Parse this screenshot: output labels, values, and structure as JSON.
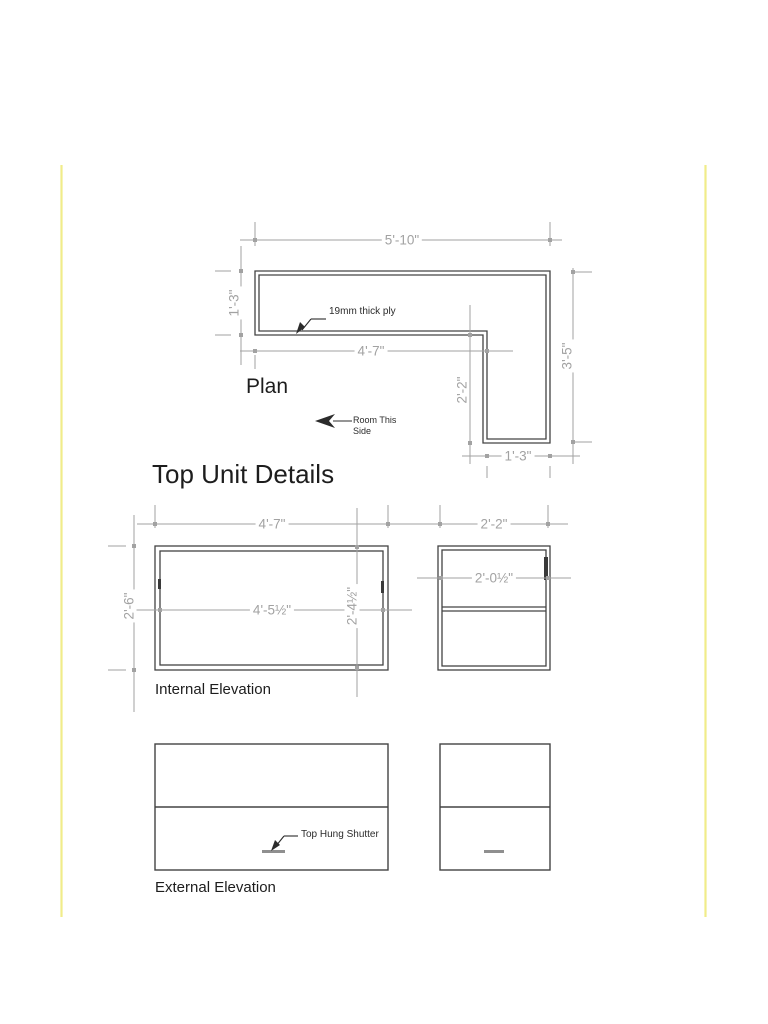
{
  "page": {
    "title": "Top Unit Details"
  },
  "plan": {
    "label": "Plan",
    "ply_note": "19mm thick ply",
    "room_note_line1": "Room This",
    "room_note_line2": "Side",
    "dim_top_width": "5'-10\"",
    "dim_left_depth": "1'-3\"",
    "dim_inner_width": "4'-7\"",
    "dim_leg_depth": "2'-2\"",
    "dim_right_height": "3'-5\"",
    "dim_leg_width": "1'-3\""
  },
  "internal_elevation": {
    "label": "Internal Elevation",
    "dim_left_unit_width": "4'-7\"",
    "dim_right_unit_width": "2'-2\"",
    "dim_unit_height": "2'-6\"",
    "dim_left_opening_width": "4'-5½\"",
    "dim_opening_height": "2'-4½\"",
    "dim_right_opening_width": "2'-0½\""
  },
  "external_elevation": {
    "label": "External Elevation",
    "shutter_note": "Top Hung Shutter"
  },
  "colors": {
    "page_edge": "#f1ec8a",
    "dimension": "#a2a2a2",
    "outline": "#434343",
    "annotation": "#2b2b2b",
    "text": "#1d1d1d",
    "handle": "#8f8f8f"
  }
}
